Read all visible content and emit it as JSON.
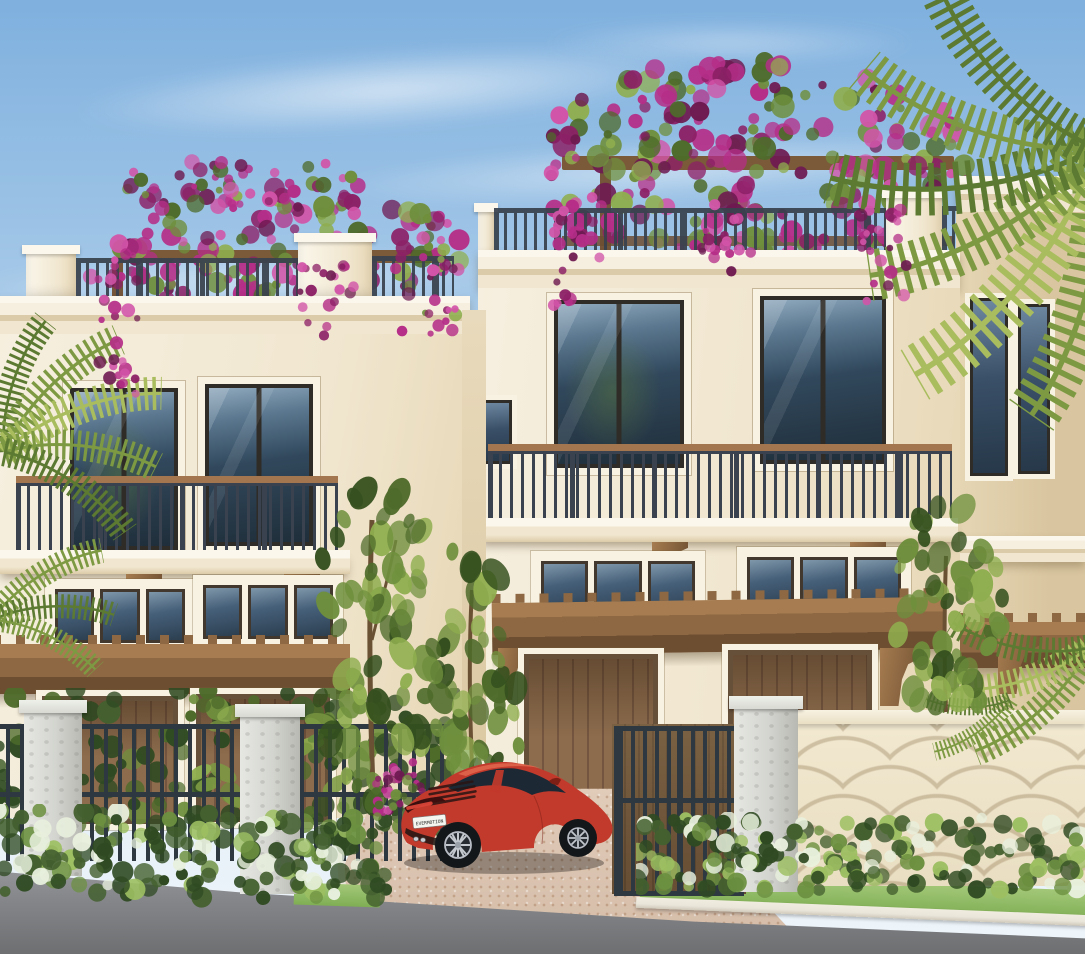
{
  "scene": {
    "type": "exterior-architectural-rendering",
    "subject": "Three-story coastal townhomes with bougainvillea-covered rooftop pergolas, iron balconies, wood garage doors, palm trees and a red sports car parked in the paver driveway",
    "car": {
      "license_plate": "EVERMOTION",
      "body_color": "#c23a2c"
    },
    "colors": {
      "sky_top": "#7fb0de",
      "sky_mid": "#a9cbe9",
      "sky_horizon": "#ddeaf5",
      "stucco_light": "#f6efdf",
      "stucco_mid": "#f1e7d0",
      "stucco_dark": "#e6d6b4",
      "stucco_side": "#d9c6a0",
      "casing": "#f8f2e2",
      "cornice_hi": "#fbf7ec",
      "cornice_sh": "#dccba8",
      "frame_dark": "#2f2b26",
      "glass_top": "#8fa9bd",
      "glass_mid": "#31485c",
      "glass_dark": "#1f2e3a",
      "iron": "#39424e",
      "fence_iron": "#2e3840",
      "wood_rail": "#a3764f",
      "pergola_hi": "#a67c50",
      "pergola_mid": "#8d6843",
      "pergola_dark": "#6e4e30",
      "garage_light": "#8d6c4d",
      "garage_dark": "#745640",
      "bloom_main": "#b52e88",
      "bloom_light": "#d254a8",
      "bloom_dark": "#8c2066",
      "bloom_deep": "#6e1a51",
      "leaf_light": "#8fae4f",
      "leaf_mid": "#6f8f3d",
      "leaf_dark": "#4e6b2b",
      "leaf_deep": "#35501e",
      "palm_light": "#a9bd5e",
      "palm_mid": "#7d9a43",
      "palm_dark": "#5c7a31",
      "hedge_dark": "#2f4a22",
      "hedge_mid": "#44602f",
      "hedge_light": "#6c9040",
      "hedge_hi": "#9dbf62",
      "grass": "#7fae54",
      "grass_light": "#a3c878",
      "trunk": "#6b5134",
      "stone": "#d3d4cf",
      "stone_hi": "#e6e7e2",
      "wall_cream": "#f2e9d1",
      "road": "#939597",
      "road_dark": "#6d6f71",
      "curb": "#eae6da",
      "drive": "#dcc6b2",
      "car_red": "#c23a2c",
      "car_dark": "#7e1f15",
      "car_hi": "#e2684f",
      "car_glass": "#1c2935",
      "plate_bg": "#f5f5f0",
      "plate_text": "#2b2b2b"
    }
  }
}
